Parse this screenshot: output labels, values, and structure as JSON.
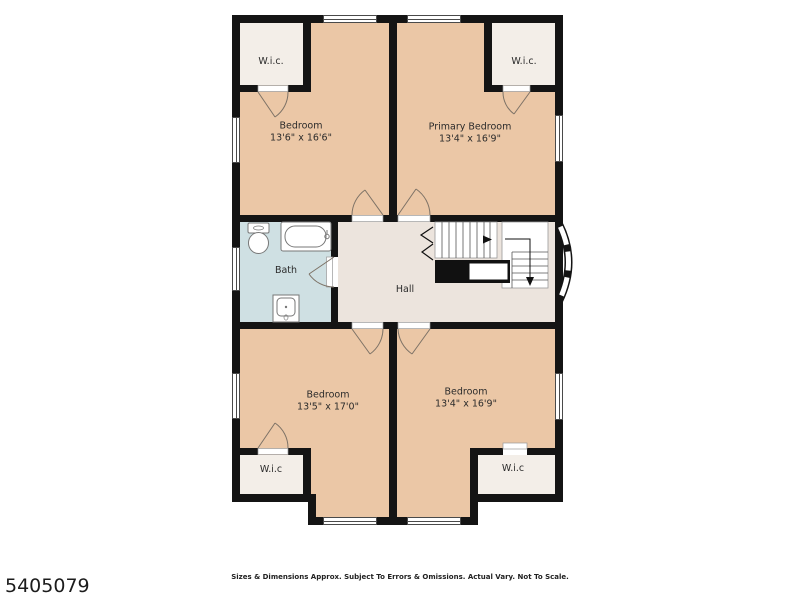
{
  "plan": {
    "rooms": {
      "wic_top_left": {
        "label": "W.i.c."
      },
      "wic_top_right": {
        "label": "W.i.c."
      },
      "wic_bottom_left": {
        "label": "W.i.c"
      },
      "wic_bottom_right": {
        "label": "W.i.c"
      },
      "bedroom_top_left": {
        "name": "Bedroom",
        "dims": "13'6\" x 16'6\""
      },
      "primary_bedroom": {
        "name": "Primary Bedroom",
        "dims": "13'4\" x 16'9\""
      },
      "bedroom_bottom_left": {
        "name": "Bedroom",
        "dims": "13'5\" x 17'0\""
      },
      "bedroom_bottom_right": {
        "name": "Bedroom",
        "dims": "13'4\" x 16'9\""
      },
      "bath": {
        "name": "Bath"
      },
      "hall": {
        "name": "Hall"
      }
    }
  },
  "colors": {
    "wall": "#141414",
    "bedroom_fill": "#ebc7a6",
    "closet_fill": "#f3eee8",
    "bath_fill": "#cfe0e3",
    "hall_fill": "#ece4dd"
  },
  "footer": {
    "listing_id": "5405079",
    "disclaimer": "Sizes & Dimensions Approx. Subject To Errors & Omissions. Actual Vary. Not To Scale."
  }
}
